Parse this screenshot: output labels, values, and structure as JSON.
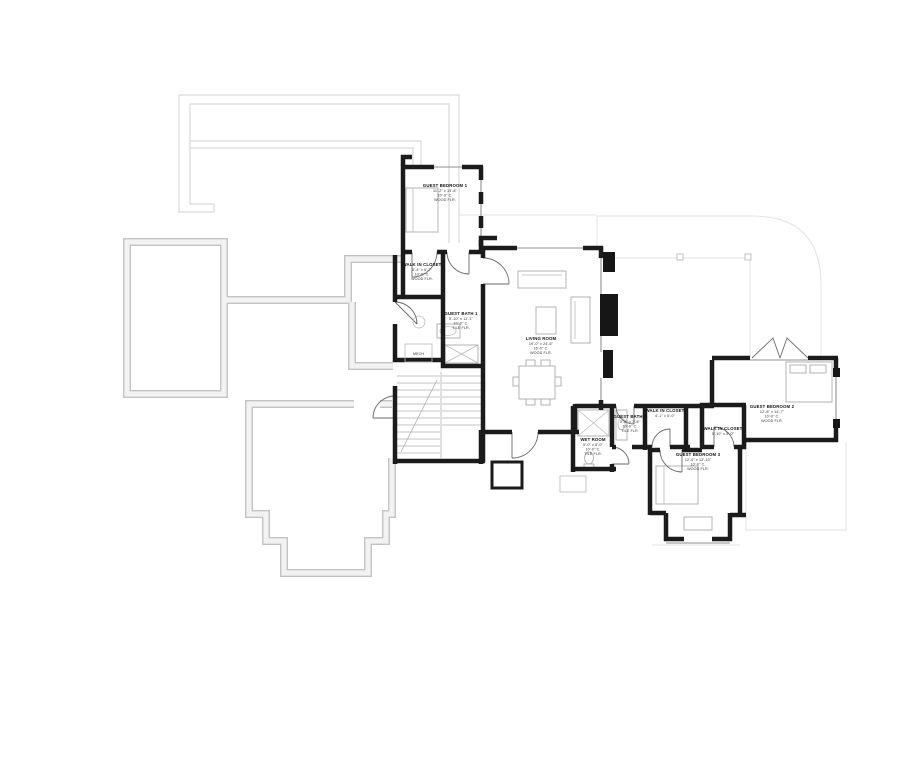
{
  "plan": {
    "rooms": [
      {
        "name": "GUEST BEDROOM 1",
        "dims": "11'-2\" x 13'-8\"",
        "ceiling": "10'-0\" C.",
        "floor": "WOOD FLR."
      },
      {
        "name": "WALK IN CLOSET",
        "dims": "6'-4\" x 6'-7\"",
        "ceiling": "10'-0\" C.",
        "floor": "WOOD FLR."
      },
      {
        "name": "GUEST BATH 1",
        "dims": "5'-10\" x 11'-1\"",
        "ceiling": "10'-0\" C.",
        "floor": "TILE FLR."
      },
      {
        "name": "LIVING ROOM",
        "dims": "19'-0\" x 24'-6\"",
        "ceiling": "16'-0\" C.",
        "floor": "WOOD FLR."
      },
      {
        "name": "WET ROOM",
        "dims": "5'-0\" x 8'-0\"",
        "ceiling": "10'-0\" C.",
        "floor": "TILE FLR."
      },
      {
        "name": "GUEST BATH 2",
        "dims": "5'-5\" x 7'-8\"",
        "ceiling": "10'-0\" C.",
        "floor": "TILE FLR."
      },
      {
        "name": "WALK IN CLOSET",
        "dims": "4'-1\" x 5'-0\""
      },
      {
        "name": "WALK IN CLOSET",
        "dims": "5'-10\" x 5'-0\""
      },
      {
        "name": "GUEST BEDROOM 3",
        "dims": "12'-6\" x 13'-10\"",
        "ceiling": "10'-0\" C.",
        "floor": "WOOD FLR."
      },
      {
        "name": "GUEST BEDROOM 2",
        "dims": "12'-8\" x 14'-7\"",
        "ceiling": "10'-0\" C.",
        "floor": "WOOD FLR."
      }
    ],
    "labels": {
      "mech": "MECH"
    },
    "colors": {
      "wall": "#1b1b1b",
      "foundation": "#c3c3c3",
      "upper_outline": "#d9d9d9",
      "furniture": "#b3b3b3",
      "glass": "#8f8f8f",
      "background": "#ffffff"
    }
  }
}
